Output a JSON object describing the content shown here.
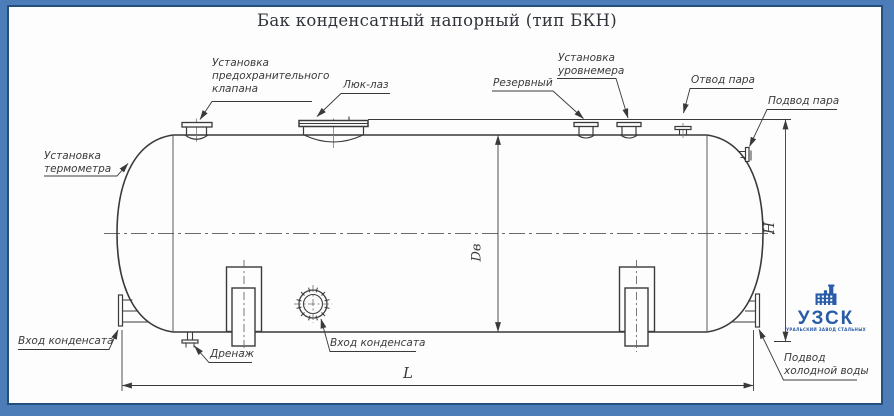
{
  "title": "Бак конденсатный напорный (тип БКН)",
  "drawing": {
    "callouts": {
      "thermometer": "Установка\nтермометра",
      "safety_valve": "Установка\nпредохранительного\nклапана",
      "manhole": "Люк-лаз",
      "reserve": "Резервный",
      "level_gauge": "Установка\nуровнемера",
      "steam_outlet": "Отвод пара",
      "steam_inlet": "Подвод пара",
      "condensate_inlet_left": "Вход конденсата",
      "drain": "Дренаж",
      "condensate_inlet_front": "Вход конденсата",
      "cold_water_inlet": "Подвод\nхолодной воды"
    },
    "dimensions": {
      "diameter": "Dв",
      "height": "H",
      "length": "L"
    }
  },
  "logo": {
    "name": "УЗСК",
    "tagline": "УРАЛЬСКИЙ ЗАВОД СТАЛЬНЫХ КОНСТРУКЦИЙ"
  },
  "colors": {
    "frame": "#4d7db8",
    "frame_edge": "#24507f",
    "sheet": "#fdfdfd",
    "line": "#3a3a3a",
    "thin_line": "#5a5a5a",
    "logo_blue": "#2a5ba6"
  }
}
